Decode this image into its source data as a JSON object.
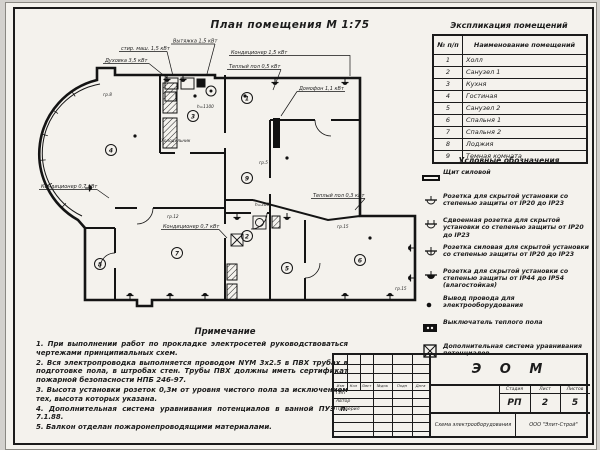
{
  "plan": {
    "title": "План помещения М 1:75",
    "rooms": [
      "1",
      "2",
      "3",
      "4",
      "5",
      "6",
      "7",
      "8",
      "9"
    ],
    "annotations": [
      "стир. маш. 1,5 кВт",
      "Вытяжка 1,5 кВт",
      "Кондиционер 1,5 кВт",
      "Теплый пол 0,5 кВт",
      "Духовка 3,5 кВт",
      "Холодильник",
      "Кондиционер 0,7 кВт",
      "Кондиционер 0,7 кВт",
      "Теплый пол 0,3 кВт",
      "Домофон 1,1 кВт"
    ],
    "small_labels": [
      "гр.5",
      "гр.15",
      "гр.12",
      "гр.8",
      "гр.15",
      "h=1100",
      "h=300"
    ]
  },
  "explication": {
    "title": "Экспликация помещений",
    "col_num": "№ п/п",
    "col_name": "Наименование помещений",
    "rows": [
      {
        "n": "1",
        "name": "Холл"
      },
      {
        "n": "2",
        "name": "Санузел 1"
      },
      {
        "n": "3",
        "name": "Кухня"
      },
      {
        "n": "4",
        "name": "Гостиная"
      },
      {
        "n": "5",
        "name": "Санузел 2"
      },
      {
        "n": "6",
        "name": "Спальня 1"
      },
      {
        "n": "7",
        "name": "Спальня 2"
      },
      {
        "n": "8",
        "name": "Лоджия"
      },
      {
        "n": "9",
        "name": "Темная комната"
      }
    ]
  },
  "legend": {
    "title": "Условные обозначения",
    "items": [
      {
        "text": "Щит силовой"
      },
      {
        "text": "Розетка для скрытой установки со степенью защиты от IP20 до IP23"
      },
      {
        "text": "Сдвоенная розетка для скрытой установки со степенью защиты от IP20 до IP23"
      },
      {
        "text": "Розетка силовая для скрытой установки со степенью защиты от IP20 до IP23"
      },
      {
        "text": "Розетка для скрытой установки со степенью защиты от IP44 до IP54 (влагостойкая)"
      },
      {
        "text": "Вывод провода для электрооборудования"
      },
      {
        "text": "Выключатель теплого пола"
      },
      {
        "text": "Дополнительная система уравнивания потенциалов"
      }
    ]
  },
  "notes": {
    "title": "Примечание",
    "items": [
      "1. При выполнении работ по прокладке электросетей руководствоваться чертежами принципиальных схем.",
      "2. Вся электропроводка выполняется проводом NYM 3х2.5 в ПВХ трубах в подготовке пола, в штробах стен. Трубы ПВХ должны иметь сертификат пожарной безопасности НПБ 246-97.",
      "3. Высота установки розеток 0,3м от уровня чистого пола за исключением тех, высота которых указана.",
      "4. Дополнительная система уравнивания потенциалов в ванной ПУЭ п. 7.1.88.",
      "5. Балкон отделан пожаронепроводящими материалами."
    ]
  },
  "stamp": {
    "code": "Э О М",
    "stage_label": "Стадия",
    "stage": "РП",
    "sheet_label": "Лист",
    "sheet": "2",
    "sheets_label": "Листов",
    "sheets": "5",
    "doc_name": "Схема электрооборудования",
    "company": "ООО \"Элит-Строй\"",
    "roles": [
      "ГИП",
      "Автор",
      "Проверил"
    ],
    "cols": [
      "Изм",
      "Кол",
      "Лист",
      "№док",
      "Подп",
      "Дата"
    ]
  }
}
